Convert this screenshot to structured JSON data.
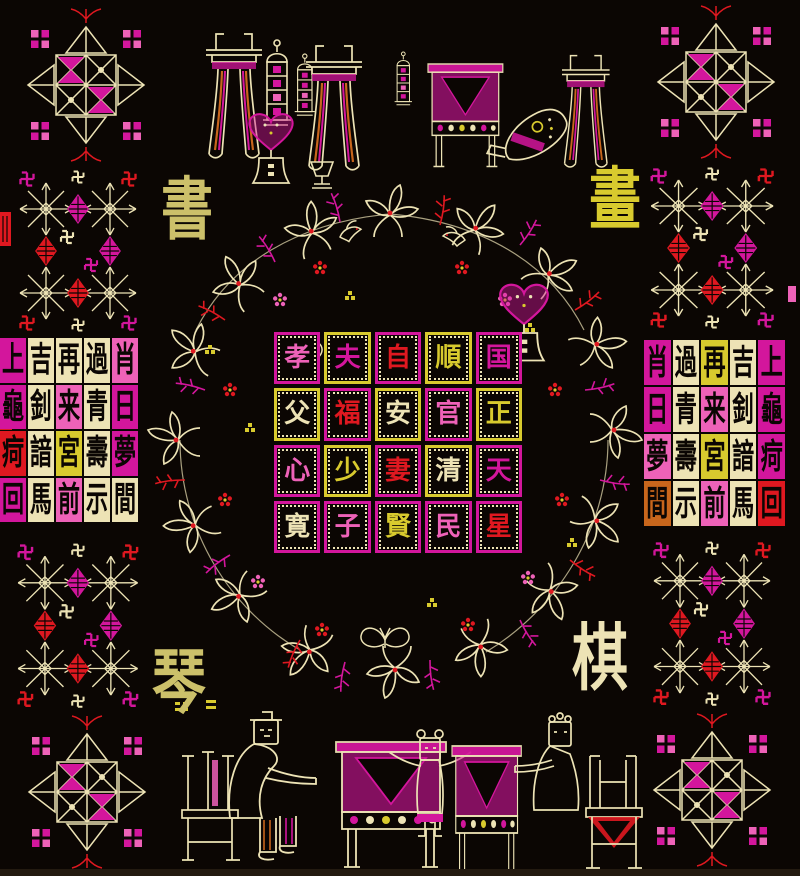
{
  "palette": {
    "background": "#0B0603",
    "cream": "#EDE3B5",
    "yellow": "#D8CA2E",
    "olive": "#CCC06A",
    "magenta": "#D3169C",
    "pink": "#EE62B8",
    "red": "#DF1820",
    "orange": "#C8661C"
  },
  "calligraphy": {
    "top_left": "書",
    "top_right": "畫",
    "bottom_left": "琴",
    "bottom_right": "棋"
  },
  "center_grid": {
    "rows": 4,
    "cols": 5,
    "cells": [
      {
        "char": "孝",
        "color": "pink",
        "frame": "magenta"
      },
      {
        "char": "夫",
        "color": "magenta",
        "frame": "yellow"
      },
      {
        "char": "自",
        "color": "red",
        "frame": "magenta"
      },
      {
        "char": "順",
        "color": "yellow",
        "frame": "yellow"
      },
      {
        "char": "国",
        "color": "magenta",
        "frame": "magenta"
      },
      {
        "char": "父",
        "color": "cream",
        "frame": "yellow"
      },
      {
        "char": "福",
        "color": "red",
        "frame": "magenta"
      },
      {
        "char": "安",
        "color": "cream",
        "frame": "yellow"
      },
      {
        "char": "官",
        "color": "pink",
        "frame": "magenta"
      },
      {
        "char": "正",
        "color": "yellow",
        "frame": "yellow"
      },
      {
        "char": "心",
        "color": "pink",
        "frame": "magenta"
      },
      {
        "char": "少",
        "color": "yellow",
        "frame": "yellow"
      },
      {
        "char": "妻",
        "color": "red",
        "frame": "magenta"
      },
      {
        "char": "清",
        "color": "cream",
        "frame": "yellow"
      },
      {
        "char": "天",
        "color": "magenta",
        "frame": "magenta"
      },
      {
        "char": "寛",
        "color": "cream",
        "frame": "magenta"
      },
      {
        "char": "子",
        "color": "pink",
        "frame": "magenta"
      },
      {
        "char": "賢",
        "color": "yellow",
        "frame": "magenta"
      },
      {
        "char": "民",
        "color": "pink",
        "frame": "magenta"
      },
      {
        "char": "星",
        "color": "red",
        "frame": "magenta"
      }
    ]
  },
  "left_seal_panel": {
    "cells": [
      {
        "char": "上",
        "bg": "magenta"
      },
      {
        "char": "吉",
        "bg": "cream"
      },
      {
        "char": "再",
        "bg": "cream"
      },
      {
        "char": "過",
        "bg": "cream"
      },
      {
        "char": "肖",
        "bg": "pink"
      },
      {
        "char": "龜",
        "bg": "magenta"
      },
      {
        "char": "釗",
        "bg": "cream"
      },
      {
        "char": "来",
        "bg": "pink"
      },
      {
        "char": "青",
        "bg": "cream"
      },
      {
        "char": "日",
        "bg": "magenta"
      },
      {
        "char": "疴",
        "bg": "red"
      },
      {
        "char": "諳",
        "bg": "cream"
      },
      {
        "char": "宮",
        "bg": "yellow"
      },
      {
        "char": "壽",
        "bg": "cream"
      },
      {
        "char": "夢",
        "bg": "magenta"
      },
      {
        "char": "回",
        "bg": "magenta"
      },
      {
        "char": "馬",
        "bg": "cream"
      },
      {
        "char": "前",
        "bg": "pink"
      },
      {
        "char": "示",
        "bg": "cream"
      },
      {
        "char": "間",
        "bg": "cream"
      }
    ]
  },
  "right_seal_panel": {
    "cells": [
      {
        "char": "肖",
        "bg": "magenta"
      },
      {
        "char": "過",
        "bg": "cream"
      },
      {
        "char": "再",
        "bg": "yellow"
      },
      {
        "char": "吉",
        "bg": "cream"
      },
      {
        "char": "上",
        "bg": "magenta"
      },
      {
        "char": "日",
        "bg": "magenta"
      },
      {
        "char": "青",
        "bg": "cream"
      },
      {
        "char": "来",
        "bg": "pink"
      },
      {
        "char": "釗",
        "bg": "cream"
      },
      {
        "char": "龜",
        "bg": "magenta"
      },
      {
        "char": "夢",
        "bg": "pink"
      },
      {
        "char": "壽",
        "bg": "cream"
      },
      {
        "char": "宮",
        "bg": "yellow"
      },
      {
        "char": "諳",
        "bg": "cream"
      },
      {
        "char": "疴",
        "bg": "magenta"
      },
      {
        "char": "間",
        "bg": "orange"
      },
      {
        "char": "示",
        "bg": "cream"
      },
      {
        "char": "前",
        "bg": "pink"
      },
      {
        "char": "馬",
        "bg": "cream"
      },
      {
        "char": "回",
        "bg": "red"
      }
    ]
  },
  "motifs": {
    "corner": "eight-point-star-medallion",
    "side_panels": "snowflake-lattice-wan-fret",
    "wreath": "floral-wreath-ring",
    "top_scene": "altar-offering-vessels",
    "bottom_scene": "family-banquet-figures"
  }
}
